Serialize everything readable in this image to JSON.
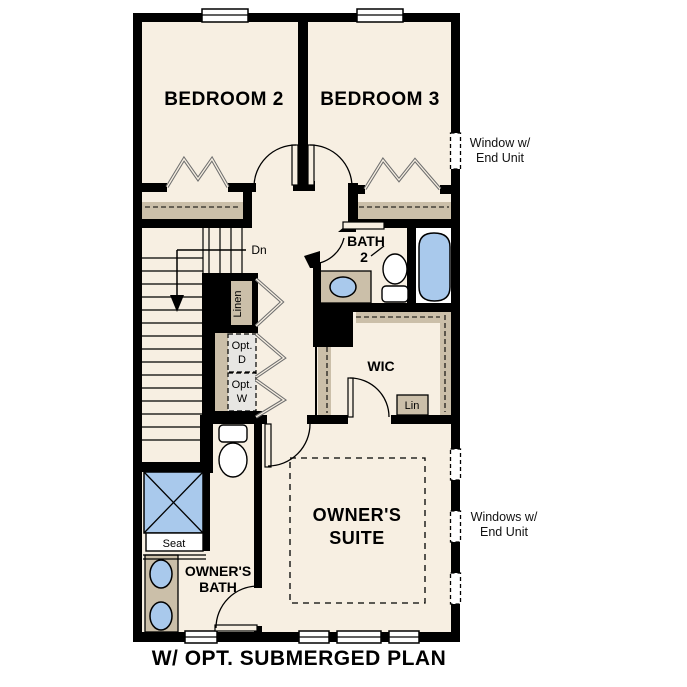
{
  "title": "W/ OPT. SUBMERGED PLAN",
  "rooms": {
    "bedroom2": "BEDROOM 2",
    "bedroom3": "BEDROOM 3",
    "bath2": {
      "line1": "BATH",
      "line2": "2"
    },
    "wic": "WIC",
    "owners_suite": {
      "line1": "OWNER'S",
      "line2": "SUITE"
    },
    "owners_bath": {
      "line1": "OWNER'S",
      "line2": "BATH"
    }
  },
  "closets": {
    "linen": "Linen",
    "lin": "Lin"
  },
  "appliances": {
    "opt_dryer": {
      "line1": "Opt.",
      "line2": "D"
    },
    "opt_washer": {
      "line1": "Opt.",
      "line2": "W"
    }
  },
  "stairs": {
    "down": "Dn"
  },
  "shower": {
    "seat": "Seat"
  },
  "notes": {
    "window_end_unit": {
      "line1": "Window w/",
      "line2": "End Unit"
    },
    "windows_end_unit": {
      "line1": "Windows w/",
      "line2": "End Unit"
    }
  },
  "colors": {
    "background": "#ffffff",
    "floor": "#f7efe2",
    "casework_tan": "#cbbfa9",
    "fixture_blue": "#a9c9ec",
    "wall": "#000000",
    "optional_appliance_gray": "#e7e6e3"
  }
}
